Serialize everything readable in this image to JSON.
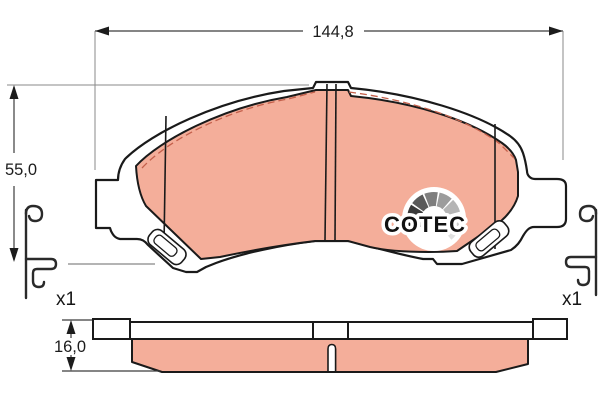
{
  "diagram": {
    "dimensions": {
      "width": "144,8",
      "height": "55,0",
      "thickness": "16,0"
    },
    "hardware": {
      "left_qty": "x1",
      "right_qty": "x1"
    },
    "logo": {
      "text": "COTEC"
    },
    "colors": {
      "friction": "#f4ae9a",
      "outline": "#1a1a1a",
      "dim_line": "#3c3c3c",
      "leader": "#9b9b9b",
      "dash": "#c4604b",
      "logo_text": "#111111"
    },
    "logo_fan_colors": [
      "#161616",
      "#3a3a3a",
      "#5a5a5a",
      "#7e7e7e",
      "#9c9c9c",
      "#b5b5b5",
      "#cccccc",
      "#e0e0e0"
    ]
  }
}
